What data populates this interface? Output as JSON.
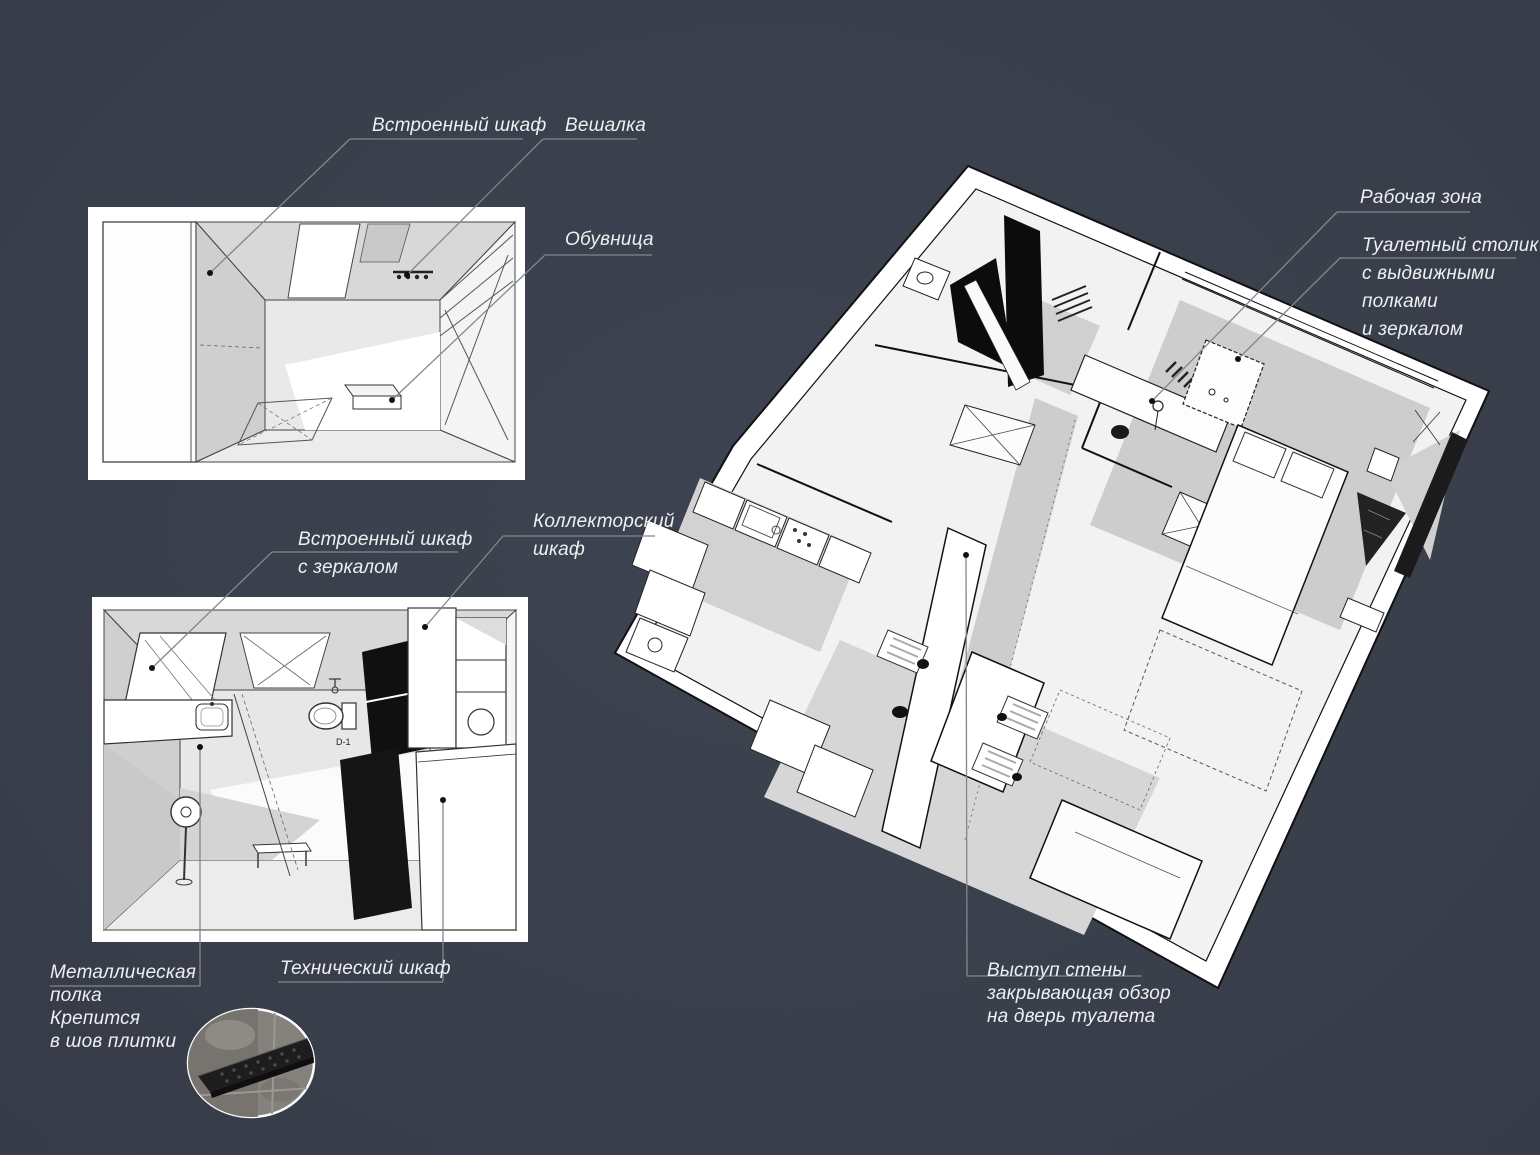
{
  "board": {
    "background_color": "#3a3f4c",
    "text_color": "#edeff1",
    "leader_line_color": "#82878f",
    "plan_paper_color": "#ffffff",
    "plan_shadow_color": "#c9c9c9",
    "accent_black": "#0c0c0c"
  },
  "views": {
    "hallway_plan": {
      "name": "hallway-top-view"
    },
    "bathroom_plan": {
      "name": "bathroom-top-view",
      "marker": "D-1"
    },
    "apartment_plan": {
      "name": "apartment-overview"
    },
    "shelf_photo": {
      "name": "metal-shelf-photo"
    }
  },
  "labels": {
    "builtin_wardrobe": "Встроенный шкаф",
    "hanger": "Вешалка",
    "shoe_rack": "Обувница",
    "builtin_wardrobe_mirror": [
      "Встроенный шкаф",
      "с зеркалом"
    ],
    "collector_cabinet": [
      "Коллекторский",
      "шкаф"
    ],
    "metal_shelf": [
      "Металлическая",
      "полка",
      "Крепится",
      "в шов плитки"
    ],
    "technical_cabinet": "Технический шкаф",
    "work_zone": "Рабочая зона",
    "dressing_table": [
      "Туалетный столик",
      "с выдвижными",
      "полками",
      "и зеркалом"
    ],
    "wall_ledge": [
      "Выступ стены",
      "закрывающая обзор",
      "на дверь туалета"
    ]
  }
}
